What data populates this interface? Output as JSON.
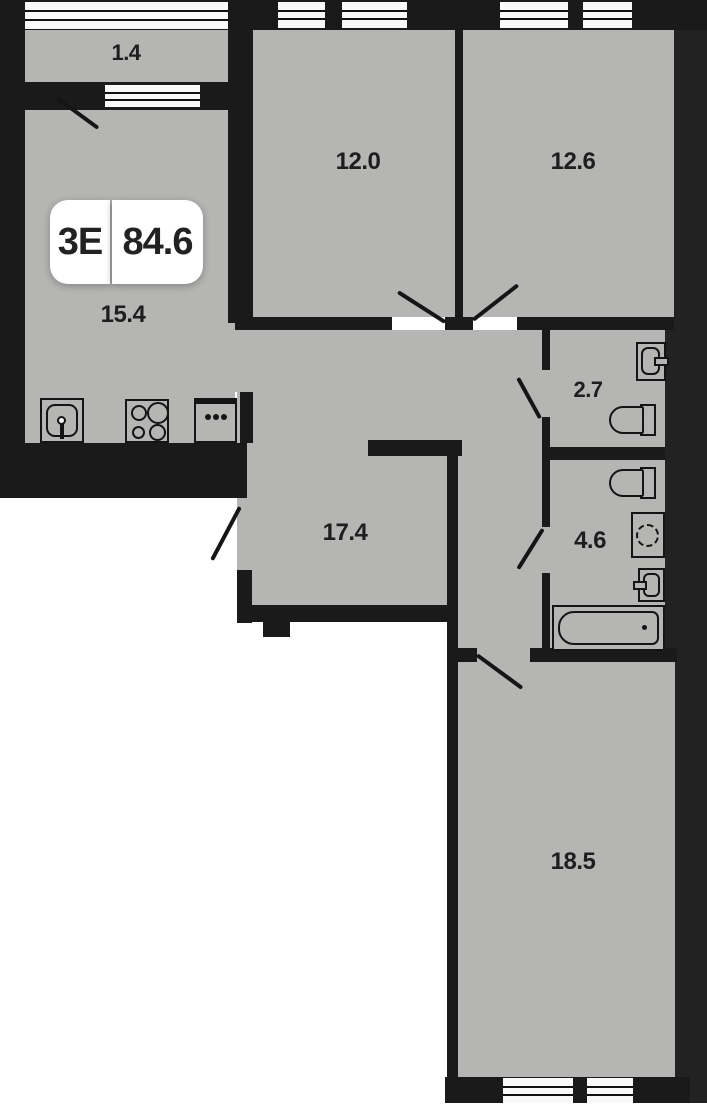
{
  "plan": {
    "badge": {
      "type_label": "3E",
      "area_label": "84.6"
    },
    "areas": {
      "balcony": "1.4",
      "bedroom1": "12.0",
      "bedroom2": "12.6",
      "kitchen": "15.4",
      "wc": "2.7",
      "bathroom": "4.6",
      "hallway": "17.4",
      "living": "18.5"
    },
    "colors": {
      "bg": "#ffffff",
      "floor": "#b5b6b4",
      "wall": "#1a1a1a",
      "mass": "#222222",
      "window": "#f9f9f9",
      "text": "#1e1e1e",
      "badge_bg": "#ffffff"
    }
  }
}
